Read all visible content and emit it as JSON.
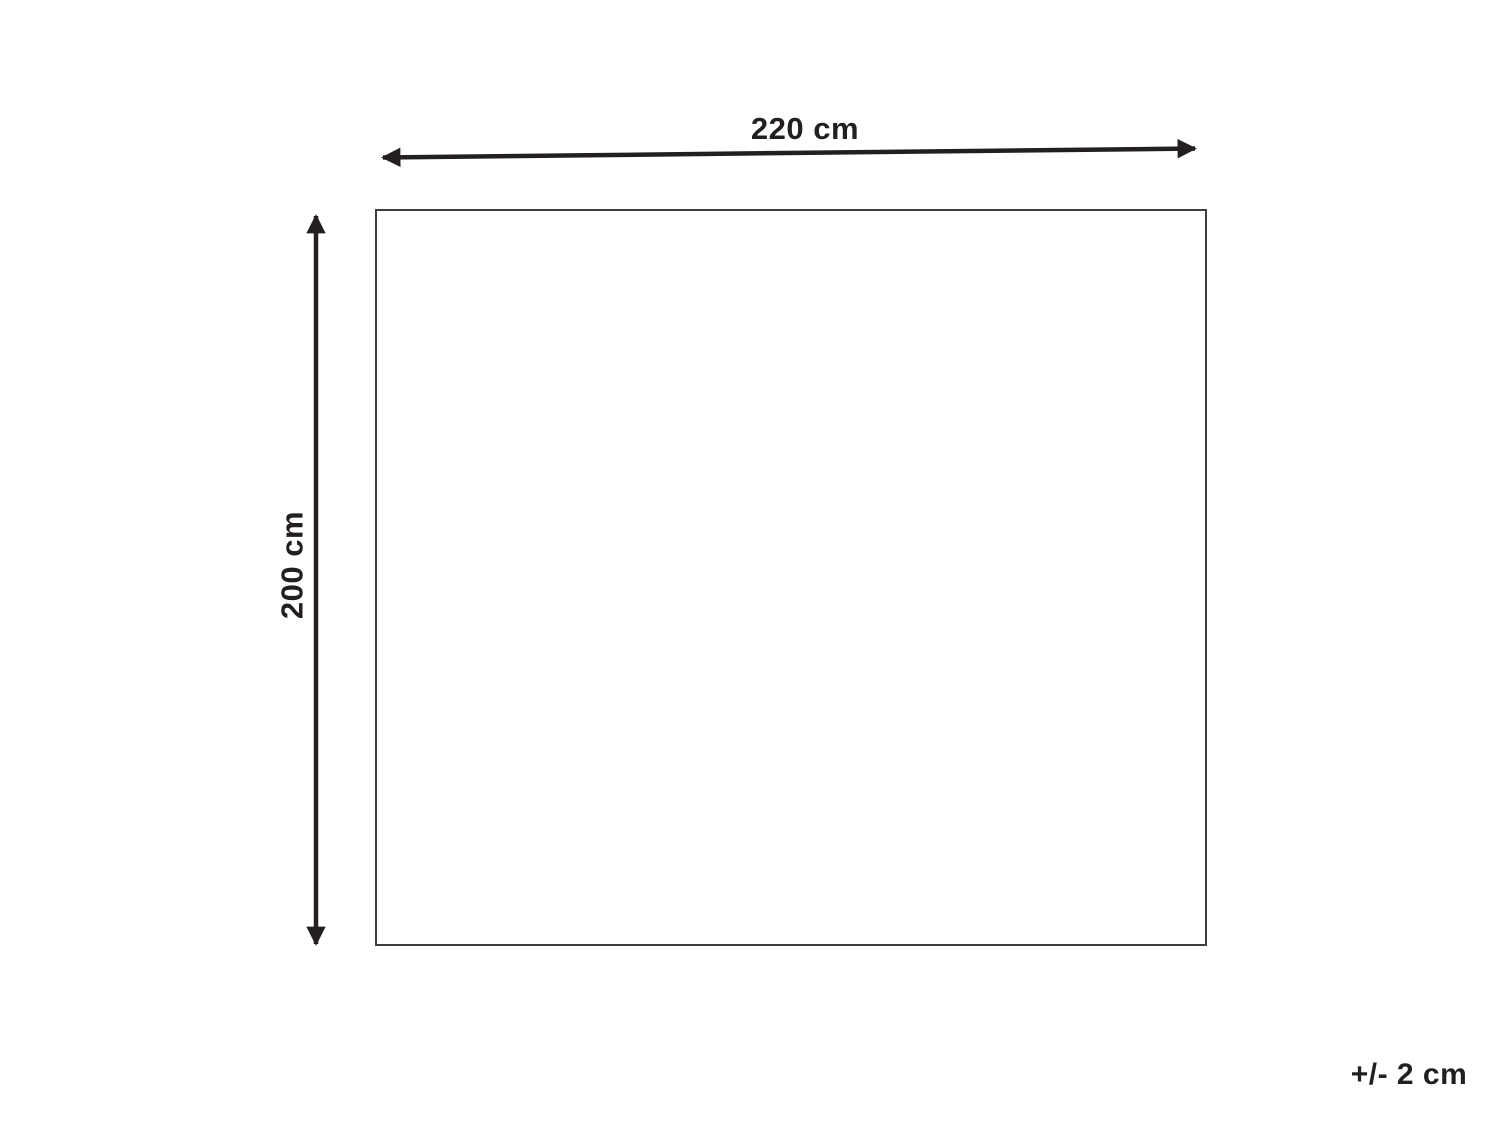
{
  "diagram": {
    "type": "product-dimension-diagram",
    "horizontal_dimension": {
      "label": "220 cm",
      "value": 220,
      "unit": "cm"
    },
    "vertical_dimension": {
      "label": "200 cm",
      "value": 200,
      "unit": "cm"
    },
    "tolerance": {
      "label": "+/- 2 cm",
      "value": 2,
      "unit": "cm"
    },
    "colors": {
      "background": "#ffffff",
      "arrow": "#231f20",
      "rect_border": "#3d3d3d",
      "text": "#231f20"
    }
  }
}
